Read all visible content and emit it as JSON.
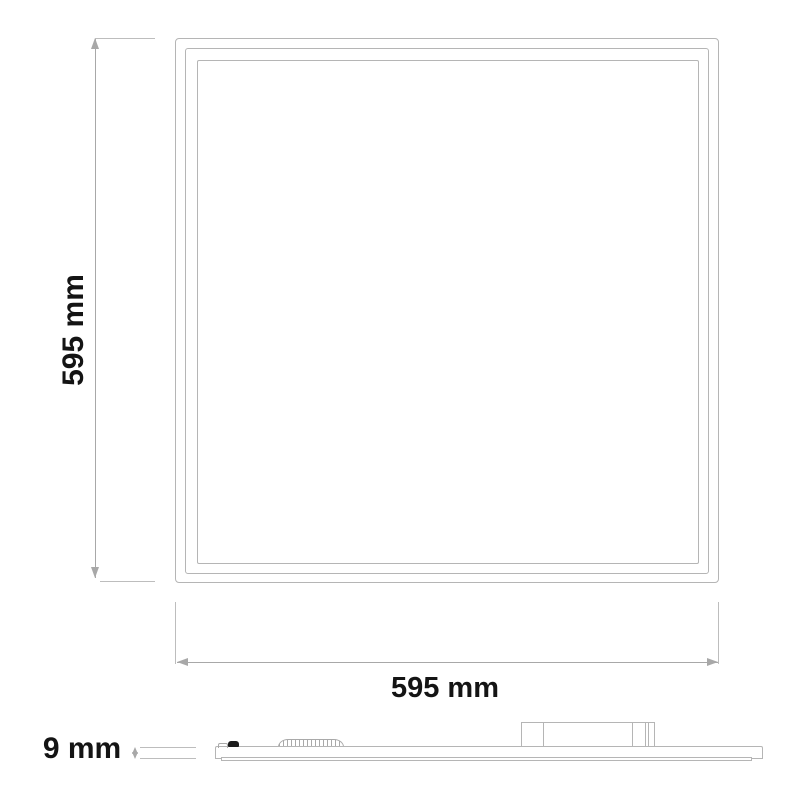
{
  "diagram": {
    "type": "technical-dimension-drawing",
    "subject": "flat LED panel light, front view and side profile view",
    "dimensions_mm": {
      "width": 595,
      "height": 595,
      "thickness": 9
    }
  },
  "labels": {
    "height": "595 mm",
    "width": "595 mm",
    "thickness": "9 mm"
  },
  "colors": {
    "line": "#b5b5b5",
    "dim": "#a8a8a8",
    "ext": "#bdbdbd",
    "text": "#141414",
    "background": "#ffffff",
    "clip": "#1c1c1c",
    "rib": "#a9a9a9"
  }
}
